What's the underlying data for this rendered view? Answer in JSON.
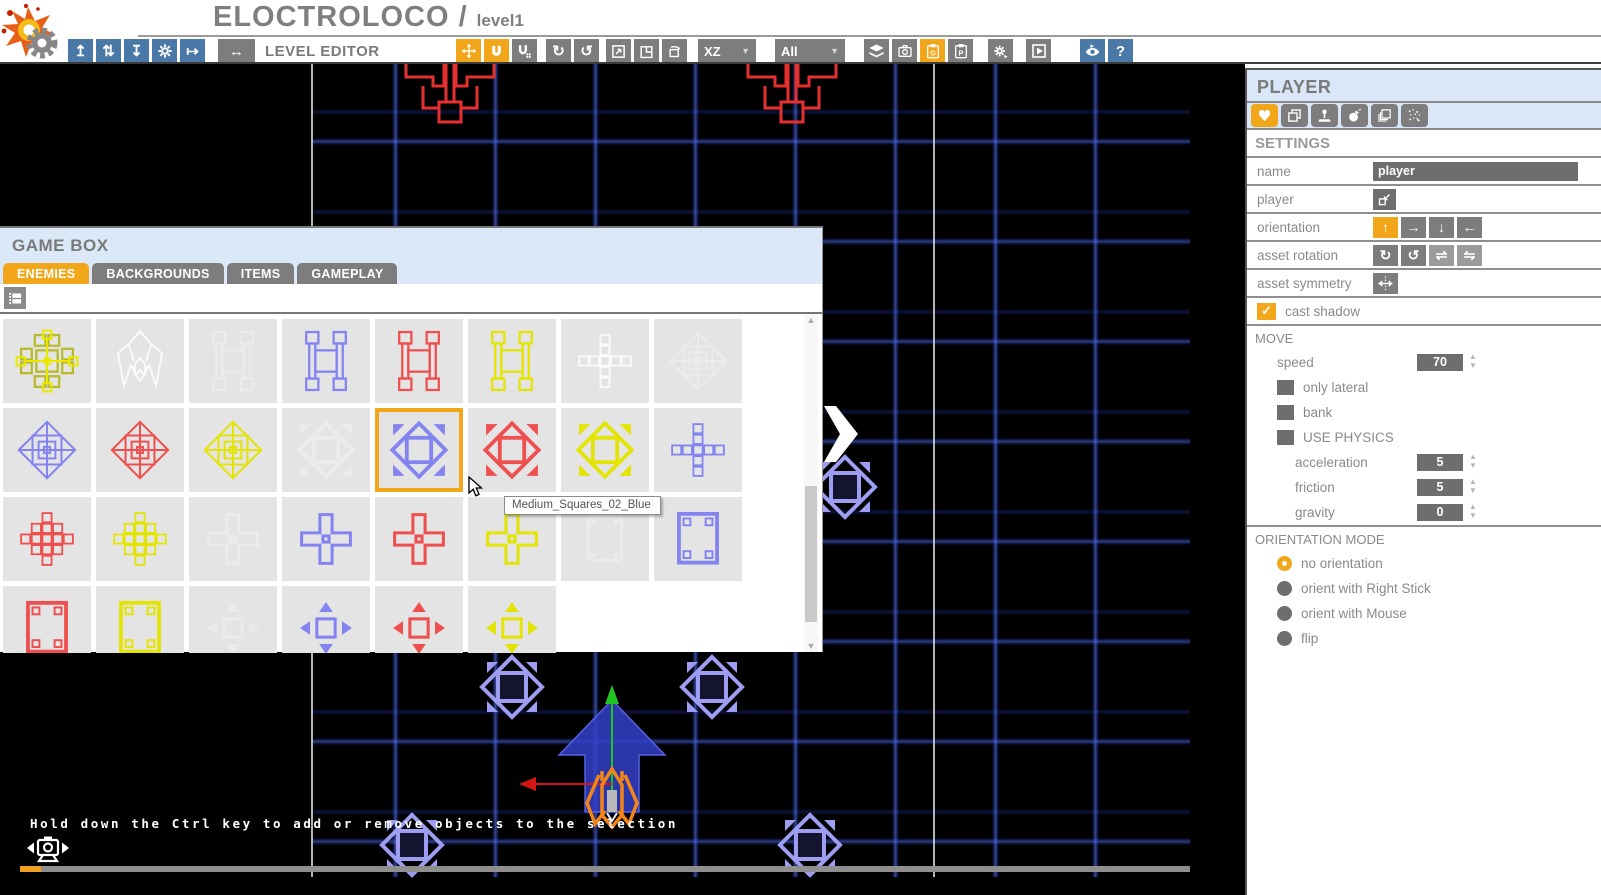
{
  "colors": {
    "accent_orange": "#F2A71B",
    "toolbar_blue": "#4A79A8",
    "panel_blue": "#DBE8F8",
    "button_gray": "#7D7D7D",
    "control_gray": "#6E6E6E",
    "grid_blue": "#2D4BDC",
    "enemy_blue": "#9D9DF2",
    "enemy_red": "#E63030",
    "player_orange": "#F28418"
  },
  "app": {
    "title": "ELOCTROLOCO /",
    "level": "level1"
  },
  "toolbar": {
    "label": "LEVEL EDITOR",
    "toggle_button": {
      "name": "level-editor-toggle-button",
      "icon": "arrows-left-right-icon",
      "glyph": "↔"
    },
    "file_buttons": [
      {
        "name": "export-level-button",
        "icon": "arrow-up-box-icon",
        "glyph": "↥"
      },
      {
        "name": "sync-level-button",
        "icon": "arrows-up-down-icon",
        "glyph": "⇅"
      },
      {
        "name": "save-level-button",
        "icon": "arrow-down-box-icon",
        "glyph": "↧"
      },
      {
        "name": "settings-button",
        "icon": "gear-icon",
        "svg": "gear"
      },
      {
        "name": "exit-editor-button",
        "icon": "arrow-exit-icon",
        "glyph": "↦"
      }
    ],
    "tool_buttons": [
      {
        "name": "move-tool-button",
        "icon": "move-arrows-icon",
        "svg": "move",
        "active": true
      },
      {
        "name": "snap-move-tool-button",
        "icon": "magnet-icon",
        "svg": "magnet",
        "active": true
      },
      {
        "name": "snap-grid-tool-button",
        "icon": "magnet-grid-icon",
        "svg": "magnetGrid"
      },
      {
        "name": "rotate-cw-tool-button",
        "icon": "rotate-cw-icon",
        "glyph": "↻"
      },
      {
        "name": "rotate-ccw-tool-button",
        "icon": "rotate-ccw-icon",
        "glyph": "↺"
      },
      {
        "name": "scale-tool-button",
        "icon": "scale-box-icon",
        "svg": "scale"
      },
      {
        "name": "flip-asset-tool-button",
        "icon": "flip-square-icon",
        "glyph": "◳"
      },
      {
        "name": "rotate-asset-tool-button",
        "icon": "rotate-square-icon",
        "svg": "boxRotate"
      }
    ],
    "axis_dropdown": {
      "name": "axis-dropdown",
      "value": "XZ"
    },
    "filter_dropdown": {
      "name": "layer-filter-dropdown",
      "value": "All"
    },
    "right_buttons": [
      {
        "name": "layers-button",
        "icon": "layers-icon",
        "svg": "layers"
      },
      {
        "name": "snapshot-button",
        "icon": "camera-icon",
        "svg": "camera"
      },
      {
        "name": "paste-gamebox-button",
        "icon": "clipboard-g-icon",
        "svg": "clipG",
        "active": true
      },
      {
        "name": "paste-properties-button",
        "icon": "clipboard-p-icon",
        "svg": "clipP"
      },
      {
        "name": "build-level-button",
        "icon": "gear-arrow-icon",
        "svg": "gearArrow"
      },
      {
        "name": "play-level-button",
        "icon": "play-icon",
        "svg": "play"
      }
    ],
    "help_buttons": [
      {
        "name": "preview-button",
        "icon": "eye-icon",
        "svg": "eye",
        "blue": true
      },
      {
        "name": "help-button",
        "icon": "question-icon",
        "glyph": "?",
        "blue": true
      }
    ]
  },
  "gamebox": {
    "title": "GAME BOX",
    "tabs": [
      {
        "label": "ENEMIES",
        "active": true
      },
      {
        "label": "BACKGROUNDS",
        "active": false
      },
      {
        "label": "ITEMS",
        "active": false
      },
      {
        "label": "GAMEPLAY",
        "active": false
      }
    ],
    "filter_button": {
      "name": "view-mode-button",
      "icon": "film-icon"
    },
    "tooltip": "Medium_Squares_02_Blue",
    "selected_tile": "Medium_Squares_02_Blue",
    "tiles": [
      {
        "type": "cross-cage",
        "color": "yellow"
      },
      {
        "type": "ship",
        "color": "white"
      },
      {
        "type": "h-cage",
        "color": "white",
        "faded": true
      },
      {
        "type": "h-cage",
        "color": "blue"
      },
      {
        "type": "h-cage",
        "color": "red"
      },
      {
        "type": "h-cage",
        "color": "yellow"
      },
      {
        "type": "plus-grid",
        "color": "white"
      },
      {
        "type": "diamond-wire",
        "color": "white",
        "faded": true
      },
      {
        "type": "diamond-wire",
        "color": "blue"
      },
      {
        "type": "diamond-wire",
        "color": "red"
      },
      {
        "type": "diamond-wire",
        "color": "yellow"
      },
      {
        "type": "diamond-solid",
        "color": "white",
        "faded": true
      },
      {
        "type": "diamond-solid",
        "color": "blue",
        "selected": true,
        "label": "Medium_Squares_02_Blue"
      },
      {
        "type": "diamond-solid",
        "color": "red"
      },
      {
        "type": "diamond-solid",
        "color": "yellow"
      },
      {
        "type": "plus-grid",
        "color": "blue"
      },
      {
        "type": "cross-grid",
        "color": "red"
      },
      {
        "type": "cross-grid",
        "color": "yellow"
      },
      {
        "type": "plus-small",
        "color": "white",
        "faded": true
      },
      {
        "type": "plus-small",
        "color": "blue"
      },
      {
        "type": "plus-small",
        "color": "red"
      },
      {
        "type": "plus-small",
        "color": "yellow"
      },
      {
        "type": "square-pad",
        "color": "white",
        "faded": true
      },
      {
        "type": "square-frame",
        "color": "blue"
      },
      {
        "type": "square-frame",
        "color": "red"
      },
      {
        "type": "square-frame",
        "color": "yellow"
      },
      {
        "type": "square-arrows",
        "color": "white",
        "faded": true
      },
      {
        "type": "square-arrows",
        "color": "blue"
      },
      {
        "type": "square-arrows",
        "color": "red"
      },
      {
        "type": "square-arrows",
        "color": "yellow"
      }
    ]
  },
  "sidebar": {
    "title": "PLAYER",
    "asset_tabs": [
      {
        "name": "tab-player-heart",
        "icon": "heart-icon",
        "active": true
      },
      {
        "name": "tab-duplicate",
        "icon": "copy-icon",
        "active": false
      },
      {
        "name": "tab-controls",
        "icon": "joystick-icon",
        "active": false
      },
      {
        "name": "tab-weapons",
        "icon": "bomb-icon",
        "active": false
      },
      {
        "name": "tab-layers",
        "icon": "pages-icon",
        "active": false
      },
      {
        "name": "tab-particles",
        "icon": "particles-icon",
        "active": false
      }
    ],
    "settings": {
      "header": "SETTINGS",
      "name_label": "name",
      "name_value": "player",
      "player_label": "player",
      "player_buttons": [
        {
          "name": "player-assign-button",
          "icon": "import-into-icon",
          "svg": "importInto",
          "dark": true
        }
      ],
      "orientation_label": "orientation",
      "orientation_buttons": [
        {
          "name": "orientation-up-button",
          "icon": "arrow-up-icon",
          "glyph": "↑",
          "active": true
        },
        {
          "name": "orientation-right-button",
          "icon": "arrow-right-icon",
          "glyph": "→"
        },
        {
          "name": "orientation-down-button",
          "icon": "arrow-down-icon",
          "glyph": "↓"
        },
        {
          "name": "orientation-left-button",
          "icon": "arrow-left-icon",
          "glyph": "←"
        }
      ],
      "asset_rotation_label": "asset rotation",
      "rotation_buttons": [
        {
          "name": "asset-rotate-cw-button",
          "icon": "rotate-cw-icon",
          "glyph": "↻"
        },
        {
          "name": "asset-rotate-ccw-button",
          "icon": "rotate-ccw-icon",
          "glyph": "↺"
        },
        {
          "name": "asset-flip-h-button",
          "icon": "flip-horizontal-icon",
          "glyph": "⇌",
          "dim": true
        },
        {
          "name": "asset-flip-v-button",
          "icon": "flip-vertical-icon",
          "glyph": "⇋",
          "dim": true
        }
      ],
      "asset_symmetry_label": "asset symmetry",
      "symmetry_buttons": [
        {
          "name": "asset-symmetry-button",
          "icon": "symmetry-icon",
          "svg": "symmetry"
        }
      ],
      "cast_shadow_label": "cast shadow",
      "cast_shadow_checked": true
    },
    "move": {
      "header": "MOVE",
      "speed_label": "speed",
      "speed_value": "70",
      "checkboxes": [
        {
          "label": "only lateral",
          "checked": false
        },
        {
          "label": "bank",
          "checked": false
        },
        {
          "label": "USE PHYSICS",
          "checked": false
        }
      ],
      "physics": [
        {
          "label": "acceleration",
          "value": "5"
        },
        {
          "label": "friction",
          "value": "5"
        },
        {
          "label": "gravity",
          "value": "0"
        }
      ]
    },
    "orientation_mode": {
      "header": "ORIENTATION MODE",
      "options": [
        {
          "label": "no orientation",
          "selected": true
        },
        {
          "label": "orient with Right Stick",
          "selected": false
        },
        {
          "label": "orient with Mouse",
          "selected": false
        },
        {
          "label": "flip",
          "selected": false
        }
      ]
    }
  },
  "canvas": {
    "hint": "Hold down the Ctrl key to add or remove objects to the selection",
    "objects": [
      "red-claw-enemy",
      "red-claw-enemy",
      "blue-diamond-enemy",
      "blue-diamond-enemy",
      "blue-diamond-enemy",
      "blue-diamond-enemy",
      "blue-diamond-enemy",
      "player-ship"
    ]
  }
}
